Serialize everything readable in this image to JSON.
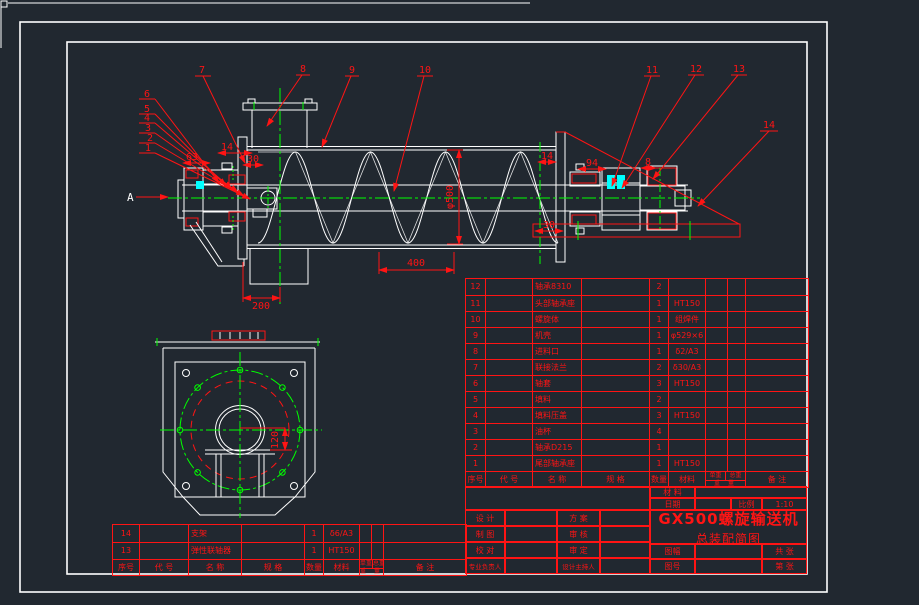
{
  "app": {
    "background_color": "#212830",
    "line_color": "#ffffff",
    "annotation_color": "#ff1414",
    "centerline_color": "#00ff00",
    "highlight_color": "#00ffff"
  },
  "drawing": {
    "view_label": "A",
    "callouts": [
      "1",
      "2",
      "3",
      "4",
      "5",
      "6",
      "7",
      "8",
      "9",
      "10",
      "11",
      "12",
      "13",
      "14"
    ],
    "dimensions": {
      "pitch": "400",
      "inlet_offset": "200",
      "screw_diameter": "φ500",
      "end_view_center_height": "120",
      "left_cover": "14",
      "left_gland": "63",
      "left_shaft_end": "30",
      "right_cover": "14",
      "right_bearing_span": "94",
      "right_gap": "8",
      "right_shaft_end": "30"
    }
  },
  "parts_list": {
    "headers": {
      "no": "序号",
      "code": "代 号",
      "name": "名 称",
      "spec": "规 格",
      "qty": "数量",
      "material": "材料",
      "unit_weight": "单重",
      "total_weight": "总重",
      "weight": "重 量",
      "remark": "备 注"
    },
    "rows": [
      {
        "no": "12",
        "code": "",
        "name": "轴承8310",
        "spec": "",
        "qty": "2",
        "material": "",
        "remark": ""
      },
      {
        "no": "11",
        "code": "",
        "name": "头部轴承座",
        "spec": "",
        "qty": "1",
        "material": "HT150",
        "remark": ""
      },
      {
        "no": "10",
        "code": "",
        "name": "螺旋体",
        "spec": "",
        "qty": "1",
        "material": "组焊件",
        "remark": ""
      },
      {
        "no": "9",
        "code": "",
        "name": "机壳",
        "spec": "",
        "qty": "1",
        "material": "φ529×6",
        "remark": ""
      },
      {
        "no": "8",
        "code": "",
        "name": "进料口",
        "spec": "",
        "qty": "1",
        "material": "δ2/A3",
        "remark": ""
      },
      {
        "no": "7",
        "code": "",
        "name": "联接法兰",
        "spec": "",
        "qty": "2",
        "material": "δ30/A3",
        "remark": ""
      },
      {
        "no": "6",
        "code": "",
        "name": "轴套",
        "spec": "",
        "qty": "3",
        "material": "HT150",
        "remark": ""
      },
      {
        "no": "5",
        "code": "",
        "name": "填料",
        "spec": "",
        "qty": "2",
        "material": "",
        "remark": ""
      },
      {
        "no": "4",
        "code": "",
        "name": "填料压盖",
        "spec": "",
        "qty": "3",
        "material": "HT150",
        "remark": ""
      },
      {
        "no": "3",
        "code": "",
        "name": "油杯",
        "spec": "",
        "qty": "4",
        "material": "",
        "remark": ""
      },
      {
        "no": "2",
        "code": "",
        "name": "轴承D215",
        "spec": "",
        "qty": "1",
        "material": "",
        "remark": ""
      },
      {
        "no": "1",
        "code": "",
        "name": "尾部轴承座",
        "spec": "",
        "qty": "1",
        "material": "HT150",
        "remark": ""
      }
    ],
    "extra_rows": [
      {
        "no": "14",
        "code": "",
        "name": "支架",
        "spec": "",
        "qty": "1",
        "material": "δ6/A3",
        "remark": ""
      },
      {
        "no": "13",
        "code": "",
        "name": "弹性联轴器",
        "spec": "",
        "qty": "1",
        "material": "HT150",
        "remark": ""
      }
    ]
  },
  "title_block": {
    "material_label": "材 料",
    "material_value": "",
    "date_label": "日期",
    "scale_label": "比例",
    "scale_value": "1:10",
    "design_label": "设 计",
    "scheme_label": "方 案",
    "draft_label": "制 图",
    "review_label": "审 核",
    "check_label": "校 对",
    "approve_label": "审 定",
    "lead_label": "专业负责人",
    "director_label": "设计主持人",
    "sheet_size_label": "图幅",
    "total_sheets_label": "共 张",
    "drawing_no_label": "图号",
    "sheet_no_label": "第 张",
    "title_line1": "GX500螺旋输送机",
    "title_line2": "总装配简图"
  }
}
